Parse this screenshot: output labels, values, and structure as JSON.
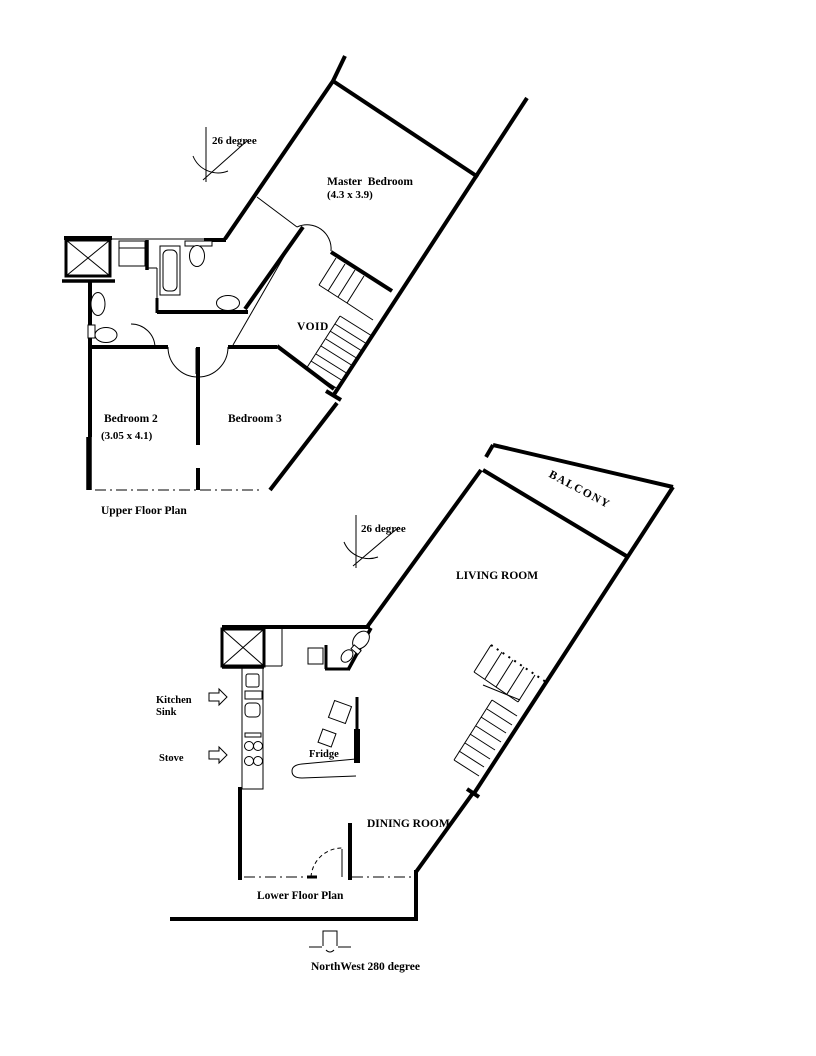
{
  "colors": {
    "background": "#ffffff",
    "ink": "#000000"
  },
  "upper_floor_plan": {
    "title": "Upper Floor Plan",
    "angle_label": "26 degree",
    "master_bedroom_label": "Master Bedroom",
    "master_bedroom_dimensions": "(4.3 x 3.9)",
    "bedroom_2_label": "Bedroom 2",
    "bedroom_2_dimensions": "(3.05 x 4.1)",
    "bedroom_3_label": "Bedroom 3",
    "void_label": "VOID"
  },
  "lower_floor_plan": {
    "title": "Lower Floor Plan",
    "angle_label": "26 degree",
    "balcony_label": "BALCONY",
    "living_room_label": "LIVING ROOM",
    "dining_room_label": "DINING ROOM",
    "kitchen_sink_label_line1": "Kitchen",
    "kitchen_sink_label_line2": "Sink",
    "stove_label": "Stove",
    "fridge_label": "Fridge"
  },
  "compass": {
    "label": "NorthWest 280 degree",
    "icon": "arrow-down"
  },
  "icons": {
    "kitchen_sink_pointer": "arrow-right",
    "stove_pointer": "arrow-right",
    "north_pointer": "arrow-down"
  }
}
